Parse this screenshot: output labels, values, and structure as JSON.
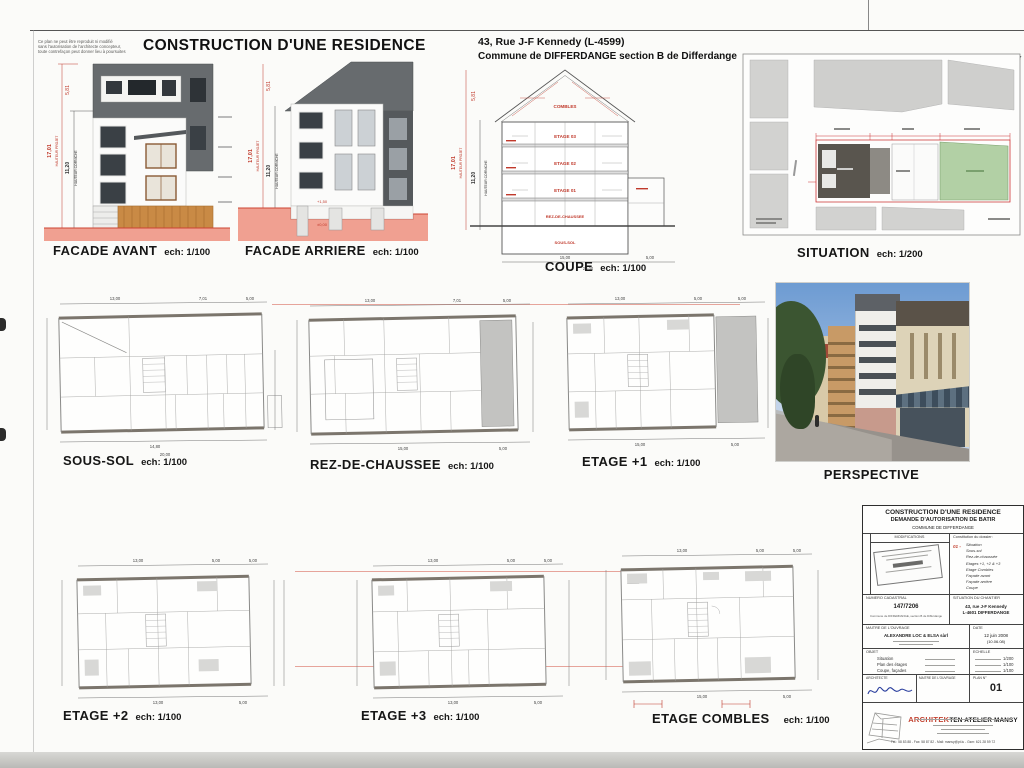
{
  "page": {
    "disclaimer_l1": "Ce plan ne peut être reproduit ni modifié",
    "disclaimer_l2": "sans l'autorisation de l'architecte concepteur,",
    "disclaimer_l3": "toute contrefaçon peut donner lieu à poursuites",
    "title": "CONSTRUCTION D'UNE RESIDENCE",
    "address1": "43, Rue J-F Kennedy (L-4599)",
    "address2": "Commune de DIFFERDANGE section B de Differdange",
    "colors": {
      "annotation_red": "#c43b2c",
      "ground_pink": "#f0a091",
      "site_green": "#b2d0a5"
    }
  },
  "architect_header": {
    "brand_red": "ARCHITEK",
    "brand_rest": "TEN ATELIER MANSY"
  },
  "views": {
    "facade_avant": {
      "label": "FACADE AVANT",
      "scale": "ech: 1/100",
      "dim_roof": "5,81",
      "dim_total": "17,01",
      "dim_total_label": "HAUTEUR PROJET",
      "dim_corniche": "11,20",
      "dim_corniche_label": "HAUTEUR CORNICHE"
    },
    "facade_arriere": {
      "label": "FACADE ARRIERE",
      "scale": "ech: 1/100",
      "dim_roof": "5,81",
      "dim_total": "17,01",
      "dim_total_label": "HAUTEUR PROJET",
      "dim_corniche": "11,20",
      "dim_corniche_label": "HAUTEUR CORNICHE",
      "mark_high": "+1,50",
      "mark_zero": "±0,00"
    },
    "coupe": {
      "label": "COUPE",
      "scale": "ech: 1/100",
      "dim_roof": "5,81",
      "dim_total": "17,01",
      "dim_total_label": "HAUTEUR PROJET",
      "dim_corniche": "11,20",
      "dim_corniche_label": "HAUTEUR CORNICHE",
      "floors": [
        "COMBLES",
        "ETAGE 03",
        "ETAGE 02",
        "ETAGE 01",
        "REZ-DE-CHAUSSEE",
        "SOUS-SOL"
      ],
      "dims_bottom": [
        "15,00",
        "5,00",
        "20,00"
      ]
    },
    "situation": {
      "label": "SITUATION",
      "scale": "ech: 1/200"
    },
    "sous_sol": {
      "label": "SOUS-SOL",
      "scale": "ech: 1/100",
      "dims_top": [
        "13,00",
        "7,01",
        "5,00"
      ],
      "dims_bottom": [
        "14,80",
        "20,00"
      ]
    },
    "rdc": {
      "label": "REZ-DE-CHAUSSEE",
      "scale": "ech: 1/100",
      "dims_top": [
        "13,00",
        "7,01",
        "5,00"
      ],
      "dims_bottom": [
        "15,00",
        "5,00"
      ]
    },
    "etage1": {
      "label": "ETAGE +1",
      "scale": "ech: 1/100",
      "dims_top": [
        "13,00",
        "5,00",
        "5,00"
      ],
      "dims_bottom": [
        "15,00",
        "5,00"
      ]
    },
    "perspective": {
      "label": "PERSPECTIVE"
    },
    "etage2": {
      "label": "ETAGE +2",
      "scale": "ech: 1/100",
      "dims_top": [
        "13,00",
        "5,00",
        "5,00"
      ],
      "dims_bottom": [
        "13,00",
        "5,00"
      ]
    },
    "etage3": {
      "label": "ETAGE +3",
      "scale": "ech: 1/100",
      "dims_top": [
        "13,00",
        "5,00",
        "5,00"
      ],
      "dims_bottom": [
        "13,00",
        "5,00"
      ]
    },
    "combles": {
      "label": "ETAGE COMBLES",
      "scale": "ech: 1/100",
      "dims_top": [
        "13,00",
        "5,00",
        "5,00"
      ],
      "dims_bottom": [
        "15,00",
        "5,00"
      ]
    }
  },
  "titleblock": {
    "title1": "CONSTRUCTION D'UNE RESIDENCE",
    "title2": "DEMANDE D'AUTORISATION DE BATIR",
    "title3": "COMMUNE DE DIFFERDANGE",
    "modifications_label": "MODIFICATIONS",
    "constitution_label": "Constitution du dossier:",
    "constitution_no": "01 -",
    "constitution_items": [
      "Situation",
      "Sous-sol",
      "Rez-de-chaussée",
      "Etages +1, +2 & +3",
      "Etage Combles",
      "Façade avant",
      "Façade arrière",
      "Coupe"
    ],
    "cadastral_label": "NUMERO CADASTRAL",
    "cadastral_value": "147/7206",
    "cadastral_sub": "Commune de DIFFERDANGE, section B de Differdange",
    "chantier_label": "SITUATION DU CHANTIER",
    "chantier_line1": "43, rue J-F Kennedy",
    "chantier_line2": "L-4601 DIFFERDANGE",
    "maitre_label": "MAITRE DE L'OUVRAGE",
    "maitre_value": "ALEXANDRE LOC & ELSA sàrl",
    "date_label": "DATE",
    "date_value": "12 juin 2008",
    "date_sub": "(10.06.08)",
    "objet_label": "OBJET",
    "objet_rows": [
      {
        "name": "Situation",
        "scale": "1/200"
      },
      {
        "name": "Plan des étages",
        "scale": "1/100"
      },
      {
        "name": "Coupe, façades",
        "scale": "1/100"
      }
    ],
    "echelle_label": "ECHELLE",
    "architecte_label": "ARCHITECTE",
    "maitre2_label": "MAITRE DE L'OUVRAGE",
    "planno_label": "PLAN N°",
    "planno_value": "01",
    "brand_red": "ARCHITEK",
    "brand_rest": "TEN ATELIER MANSY",
    "contact": "Tél.: 58 83 88  -  Fax: 58 87 82  -  Mail: mansy@pt.lu  -  Gsm: 621 28 59 72"
  }
}
